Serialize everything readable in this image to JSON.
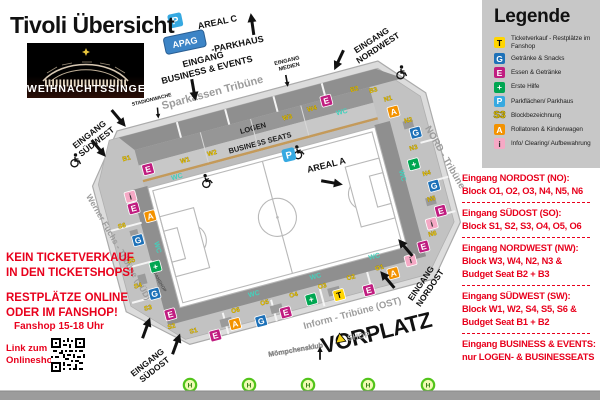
{
  "header": {
    "title": "Tivoli Übersicht",
    "banner": "WEIHNACHTSSINGEN"
  },
  "notes": {
    "no_sale_1": "KEIN TICKETVERKAUF",
    "no_sale_2": "IN DEN TICKETSHOPS!",
    "rest_1": "RESTPLÄTZE ONLINE",
    "rest_2": "ODER IM FANSHOP!",
    "fanshop_hours": "Fanshop 15-18 Uhr",
    "qr_1": "Link zum",
    "qr_2": "Onlineshop:"
  },
  "legend": {
    "title": "Legende",
    "items": [
      {
        "symbol": "T",
        "color": "#FFD500",
        "text_color": "#000000",
        "label": "Ticketverkauf - Restplätze im Fanshop"
      },
      {
        "symbol": "G",
        "color": "#1D71B8",
        "text_color": "#FFFFFF",
        "label": "Getränke & Snacks"
      },
      {
        "symbol": "E",
        "color": "#C01D80",
        "text_color": "#FFFFFF",
        "label": "Essen & Getränke"
      },
      {
        "symbol": "+",
        "color": "#00A651",
        "text_color": "#FFFFFF",
        "label": "Erste Hilfe"
      },
      {
        "symbol": "P",
        "color": "#36A9E1",
        "text_color": "#FFFFFF",
        "label": "Parkflächen/ Parkhaus"
      },
      {
        "symbol": "S3",
        "color": "none",
        "text_color": "#FFD500",
        "label": "Blockbezeichnung"
      },
      {
        "symbol": "A",
        "color": "#F39200",
        "text_color": "#FFFFFF",
        "label": "Rollatoren & Kinderwagen"
      },
      {
        "symbol": "i",
        "color": "#F5A9C5",
        "text_color": "#333333",
        "label": "Info/ Clearing/ Aufbewahrung"
      }
    ]
  },
  "entrances": {
    "sections": [
      {
        "title": "Eingang NORDOST (NO):",
        "lines": [
          "Block O1, O2, O3, N4, N5, N6"
        ]
      },
      {
        "title": "Eingang SÜDOST (SO):",
        "lines": [
          "Block S1, S2, S3, O4, O5, O6"
        ]
      },
      {
        "title": "Eingang NORDWEST (NW):",
        "lines": [
          "Block W3, W4, N2, N3 &",
          "Budget Seat B2 + B3"
        ]
      },
      {
        "title": "Eingang SÜDWEST (SW):",
        "lines": [
          "Block W1, W2, S4, S5, S6 &",
          "Budget Seat B1 + B2"
        ]
      },
      {
        "title": "Eingang BUSINESS & EVENTS:",
        "lines": [
          "nur LOGEN- & BUSINESSEATS"
        ]
      }
    ]
  },
  "map": {
    "labels": {
      "areal_c": "AREAL C",
      "apag": "APAG",
      "parkhaus": "-PARKHAUS",
      "p": "P",
      "eingang_business_1": "EINGANG",
      "eingang_business_2": "BUSINESS & EVENTS",
      "eingang_medien_1": "EINGANG",
      "eingang_medien_2": "MEDIEN",
      "eingang_nordwest_1": "EINGANG",
      "eingang_nordwest_2": "NORDWEST",
      "areal_a": "AREAL A",
      "eingang_nordost_1": "EINGANG",
      "eingang_nordost_2": "NORDOST",
      "eingang_sudost_1": "EINGANG",
      "eingang_sudost_2": "SÜDOST",
      "eingang_sudwest_1": "EINGANG",
      "eingang_sudwest_2": "SÜDWEST",
      "stadionwache": "STADIONWACHE",
      "vorplatz": "VORPLATZ",
      "fanshop": "FANSHOP",
      "moempchensklub": "Mömpchensklub",
      "shop": "SHOP",
      "logen": "LOGEN",
      "business_seats": "BUSINESS SEATS",
      "tribune_west": "Sparkassen Tribüne",
      "tribune_nord": "NORD - Tribüne",
      "tribune_ost": "Inform - Tribüne (OST)",
      "tribune_sued": "Werner Fuchs - Tribüne (SÜD)",
      "bus_stop": "H"
    },
    "icons": [
      {
        "k": "box",
        "t": "E",
        "x": 170,
        "y": 150
      },
      {
        "k": "blk",
        "t": "W1",
        "x": 208,
        "y": 153
      },
      {
        "k": "blk",
        "t": "W2",
        "x": 236,
        "y": 153
      },
      {
        "k": "wc",
        "t": "WC",
        "x": 196,
        "y": 167
      },
      {
        "k": "blk",
        "t": "B1",
        "x": 152,
        "y": 136
      },
      {
        "k": "blk",
        "t": "W3",
        "x": 318,
        "y": 138
      },
      {
        "k": "blk",
        "t": "W4",
        "x": 344,
        "y": 136
      },
      {
        "k": "box",
        "t": "E",
        "x": 360,
        "y": 130
      },
      {
        "k": "blk",
        "t": "B2",
        "x": 390,
        "y": 128
      },
      {
        "k": "blk",
        "t": "B3",
        "x": 408,
        "y": 134
      },
      {
        "k": "wc",
        "t": "WC",
        "x": 372,
        "y": 147
      },
      {
        "k": "whc",
        "t": "",
        "x": 222,
        "y": 176
      },
      {
        "k": "whc",
        "t": "",
        "x": 318,
        "y": 172
      },
      {
        "k": "box",
        "t": "i",
        "x": 146,
        "y": 172
      },
      {
        "k": "box",
        "t": "E",
        "x": 146,
        "y": 184
      },
      {
        "k": "box",
        "t": "A",
        "x": 160,
        "y": 196
      },
      {
        "k": "blk",
        "t": "S6",
        "x": 130,
        "y": 200
      },
      {
        "k": "box",
        "t": "G",
        "x": 142,
        "y": 216
      },
      {
        "k": "wc",
        "t": "WC",
        "x": 157,
        "y": 228,
        "r": 90
      },
      {
        "k": "blk",
        "t": "S5",
        "x": 130,
        "y": 236
      },
      {
        "k": "box",
        "t": "+",
        "x": 152,
        "y": 246
      },
      {
        "k": "blk",
        "t": "S4",
        "x": 130,
        "y": 262
      },
      {
        "k": "box",
        "t": "G",
        "x": 144,
        "y": 272
      },
      {
        "k": "blk",
        "t": "S3",
        "x": 134,
        "y": 286
      },
      {
        "k": "box",
        "t": "E",
        "x": 154,
        "y": 296
      },
      {
        "k": "blk",
        "t": "S2",
        "x": 152,
        "y": 310
      },
      {
        "k": "blk",
        "t": "S1",
        "x": 172,
        "y": 320
      },
      {
        "k": "box",
        "t": "E",
        "x": 192,
        "y": 328
      },
      {
        "k": "box",
        "t": "A",
        "x": 214,
        "y": 322
      },
      {
        "k": "blk",
        "t": "O6",
        "x": 218,
        "y": 311
      },
      {
        "k": "box",
        "t": "G",
        "x": 240,
        "y": 326
      },
      {
        "k": "blk",
        "t": "O5",
        "x": 248,
        "y": 311
      },
      {
        "k": "box",
        "t": "E",
        "x": 266,
        "y": 324
      },
      {
        "k": "blk",
        "t": "O4",
        "x": 278,
        "y": 311
      },
      {
        "k": "box",
        "t": "+",
        "x": 294,
        "y": 318
      },
      {
        "k": "blk",
        "t": "O3",
        "x": 308,
        "y": 310
      },
      {
        "k": "box",
        "t": "T",
        "x": 322,
        "y": 321
      },
      {
        "k": "blk",
        "t": "O2",
        "x": 338,
        "y": 309
      },
      {
        "k": "box",
        "t": "E",
        "x": 352,
        "y": 324
      },
      {
        "k": "blk",
        "t": "O1",
        "x": 368,
        "y": 307
      },
      {
        "k": "box",
        "t": "A",
        "x": 380,
        "y": 314
      },
      {
        "k": "box",
        "t": "i",
        "x": 400,
        "y": 306
      },
      {
        "k": "wc",
        "t": "WC",
        "x": 240,
        "y": 300
      },
      {
        "k": "wc",
        "t": "WC",
        "x": 304,
        "y": 299
      },
      {
        "k": "wc",
        "t": "WC",
        "x": 366,
        "y": 295
      },
      {
        "k": "box",
        "t": "A",
        "x": 422,
        "y": 158
      },
      {
        "k": "blk",
        "t": "N1",
        "x": 420,
        "y": 146
      },
      {
        "k": "blk",
        "t": "N2",
        "x": 434,
        "y": 172
      },
      {
        "k": "box",
        "t": "G",
        "x": 438,
        "y": 184
      },
      {
        "k": "blk",
        "t": "N3",
        "x": 432,
        "y": 200
      },
      {
        "k": "box",
        "t": "+",
        "x": 428,
        "y": 214
      },
      {
        "k": "blk",
        "t": "N4",
        "x": 438,
        "y": 228
      },
      {
        "k": "box",
        "t": "G",
        "x": 442,
        "y": 240
      },
      {
        "k": "wc",
        "t": "WC",
        "x": 412,
        "y": 222,
        "r": 90
      },
      {
        "k": "blk",
        "t": "N5",
        "x": 436,
        "y": 254
      },
      {
        "k": "box",
        "t": "E",
        "x": 442,
        "y": 266
      },
      {
        "k": "box",
        "t": "i",
        "x": 430,
        "y": 276
      },
      {
        "k": "blk",
        "t": "N6",
        "x": 428,
        "y": 288
      },
      {
        "k": "box",
        "t": "E",
        "x": 416,
        "y": 296
      }
    ]
  }
}
